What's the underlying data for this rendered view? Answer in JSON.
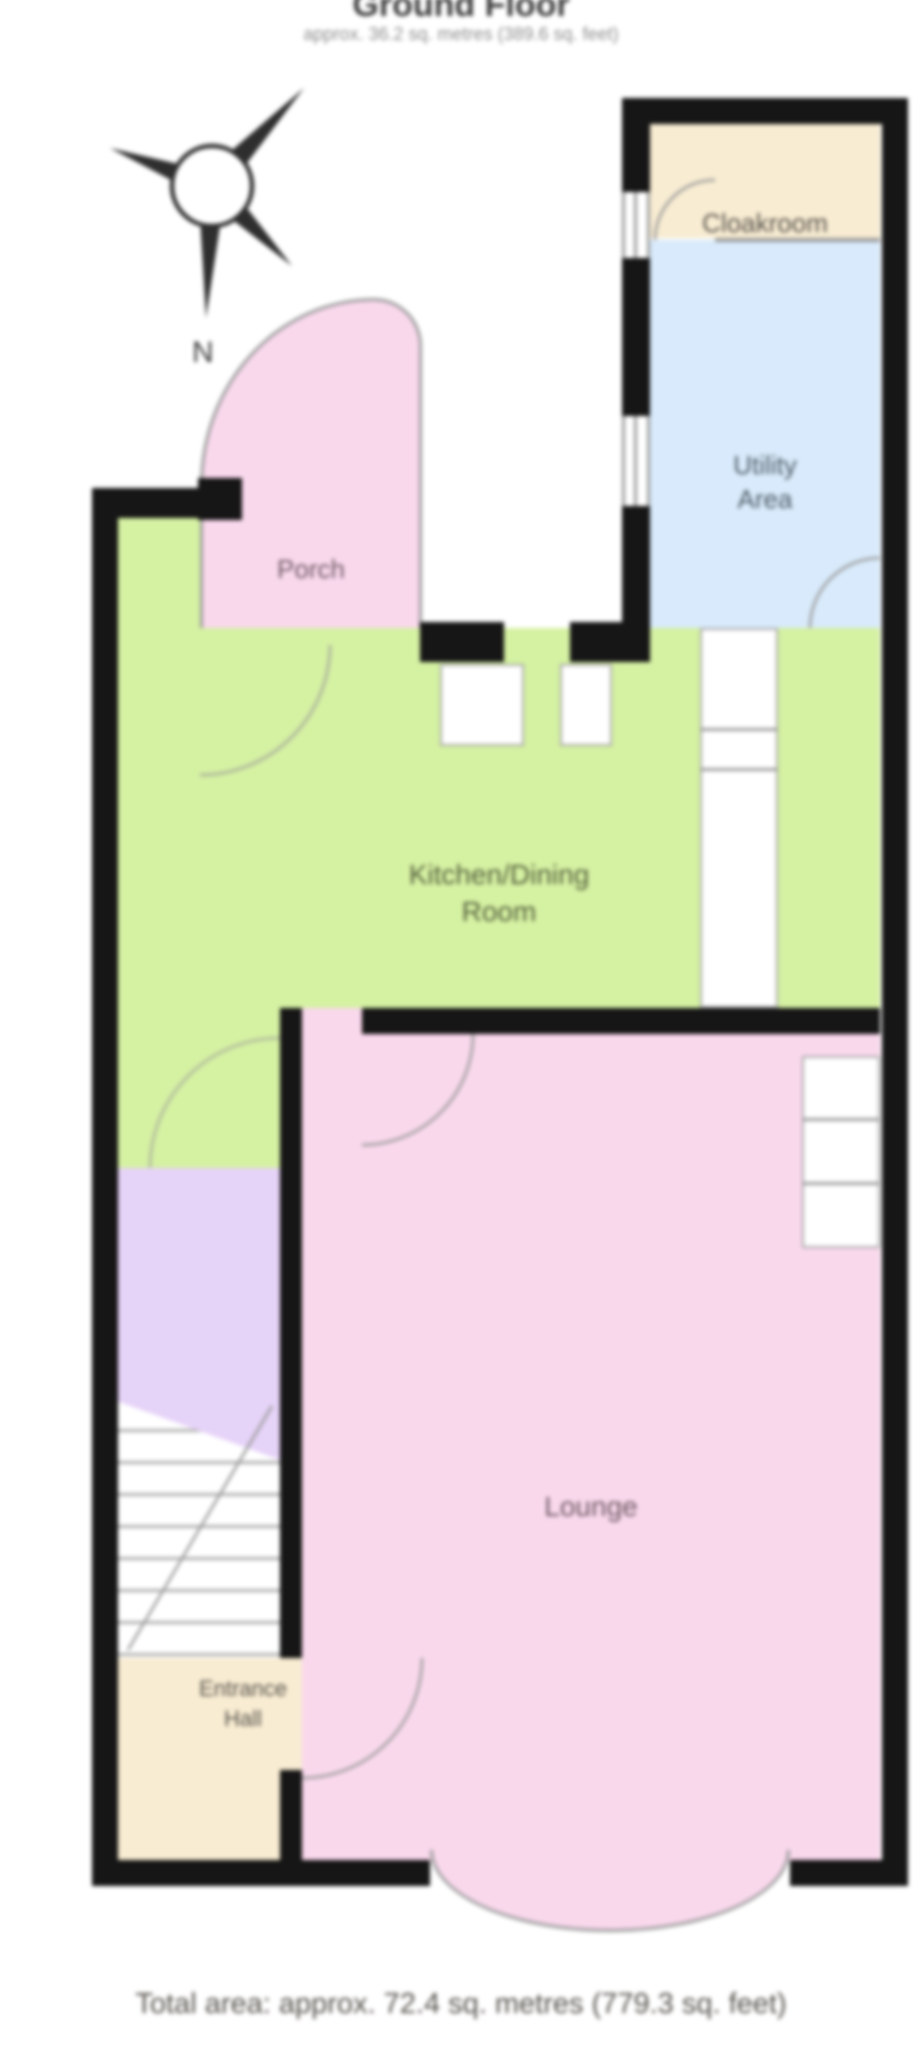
{
  "header": {
    "title": "Ground Floor",
    "subtitle": "approx. 36.2 sq. metres (389.6 sq. feet)"
  },
  "compass": {
    "north_label": "N"
  },
  "rooms": {
    "cloakroom": {
      "label": "Cloakroom"
    },
    "utility": {
      "line1": "Utility",
      "line2": "Area"
    },
    "porch": {
      "label": "Porch"
    },
    "kitchen": {
      "line1": "Kitchen/Dining",
      "line2": "Room"
    },
    "lounge": {
      "label": "Lounge"
    },
    "entrance": {
      "line1": "Entrance",
      "line2": "Hall"
    }
  },
  "footer": {
    "total_area": "Total area: approx. 72.4 sq. metres (779.3 sq. feet)"
  },
  "colors": {
    "cloakroom": "#f8ecd2",
    "utility": "#d8eafb",
    "kitchen": "#d5f1a2",
    "porch": "#f9d8ec",
    "lounge": "#f9d8ec",
    "stair_hall": "#e6d3f8",
    "entrance": "#f8ecd2",
    "wall": "#161616",
    "thin_line": "#9b9b9b"
  }
}
